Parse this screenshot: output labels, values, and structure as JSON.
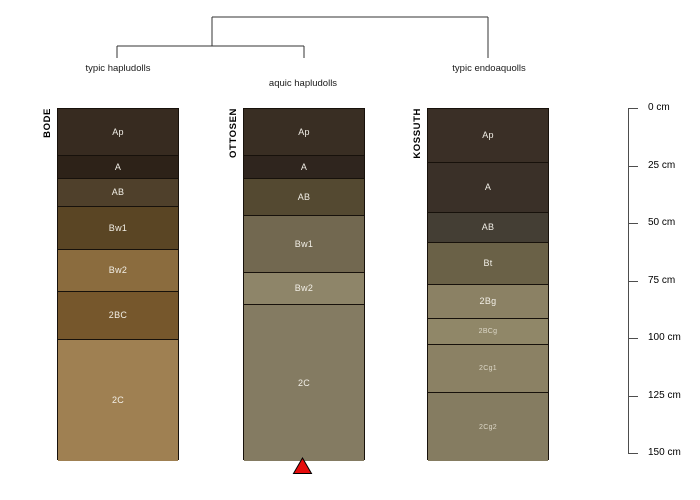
{
  "chart_data": {
    "type": "other",
    "subtype": "soil-profile-sketches-with-dendrogram",
    "depth_unit": "cm",
    "depth_axis": {
      "tick_labels": [
        "0 cm",
        "25 cm",
        "50 cm",
        "75 cm",
        "100 cm",
        "125 cm",
        "150 cm"
      ],
      "tick_values_cm": [
        0,
        25,
        50,
        75,
        100,
        125,
        150
      ],
      "range_cm": [
        0,
        150
      ]
    },
    "dendrogram": {
      "leaves": [
        {
          "label": "typic hapludolls"
        },
        {
          "label": "aquic hapludolls"
        },
        {
          "label": "typic endoaquolls"
        }
      ],
      "structure": "((typic hapludolls, aquic hapludolls), typic endoaquolls)"
    },
    "profiles": [
      {
        "id": "BODE",
        "group": "typic hapludolls",
        "horizons": [
          {
            "name": "Ap",
            "top_cm": 0,
            "bottom_cm": 20,
            "color": "#372b20"
          },
          {
            "name": "A",
            "top_cm": 20,
            "bottom_cm": 30,
            "color": "#2d2218"
          },
          {
            "name": "AB",
            "top_cm": 30,
            "bottom_cm": 42,
            "color": "#4f402b"
          },
          {
            "name": "Bw1",
            "top_cm": 42,
            "bottom_cm": 61,
            "color": "#5a4524"
          },
          {
            "name": "Bw2",
            "top_cm": 61,
            "bottom_cm": 79,
            "color": "#8b6c3e"
          },
          {
            "name": "2BC",
            "top_cm": 79,
            "bottom_cm": 100,
            "color": "#76572c"
          },
          {
            "name": "2C",
            "top_cm": 100,
            "bottom_cm": 153,
            "color": "#9f8052"
          }
        ]
      },
      {
        "id": "OTTOSEN",
        "group": "aquic hapludolls",
        "horizons": [
          {
            "name": "Ap",
            "top_cm": 0,
            "bottom_cm": 20,
            "color": "#392e23"
          },
          {
            "name": "A",
            "top_cm": 20,
            "bottom_cm": 30,
            "color": "#2f251e"
          },
          {
            "name": "AB",
            "top_cm": 30,
            "bottom_cm": 46,
            "color": "#544931"
          },
          {
            "name": "Bw1",
            "top_cm": 46,
            "bottom_cm": 71,
            "color": "#726850"
          },
          {
            "name": "Bw2",
            "top_cm": 71,
            "bottom_cm": 85,
            "color": "#8e8569"
          },
          {
            "name": "2C",
            "top_cm": 85,
            "bottom_cm": 153,
            "color": "#847b62"
          }
        ]
      },
      {
        "id": "KOSSUTH",
        "group": "typic endoaquolls",
        "horizons": [
          {
            "name": "Ap",
            "top_cm": 0,
            "bottom_cm": 23,
            "color": "#3a2f26"
          },
          {
            "name": "A",
            "top_cm": 23,
            "bottom_cm": 45,
            "color": "#3a3028"
          },
          {
            "name": "AB",
            "top_cm": 45,
            "bottom_cm": 58,
            "color": "#443e34"
          },
          {
            "name": "Bt",
            "top_cm": 58,
            "bottom_cm": 76,
            "color": "#6a6147"
          },
          {
            "name": "2Bg",
            "top_cm": 76,
            "bottom_cm": 91,
            "color": "#8b8164"
          },
          {
            "name": "2BCg",
            "top_cm": 91,
            "bottom_cm": 102,
            "color": "#908768",
            "small_label": true
          },
          {
            "name": "2Cg1",
            "top_cm": 102,
            "bottom_cm": 123,
            "color": "#8b8164",
            "small_label": true
          },
          {
            "name": "2Cg2",
            "top_cm": 123,
            "bottom_cm": 153,
            "color": "#857c61",
            "small_label": true
          }
        ]
      }
    ],
    "marker": {
      "shape": "triangle",
      "color": "#e60c0c",
      "outline": "#000000",
      "attached_to": "OTTOSEN"
    }
  },
  "colors": {
    "horizon_border": "#17110b",
    "horizon_label_text": "#f2efe7",
    "axis_line": "#4d4d4d",
    "dendrogram_line": "#333333",
    "background": "#ffffff"
  }
}
